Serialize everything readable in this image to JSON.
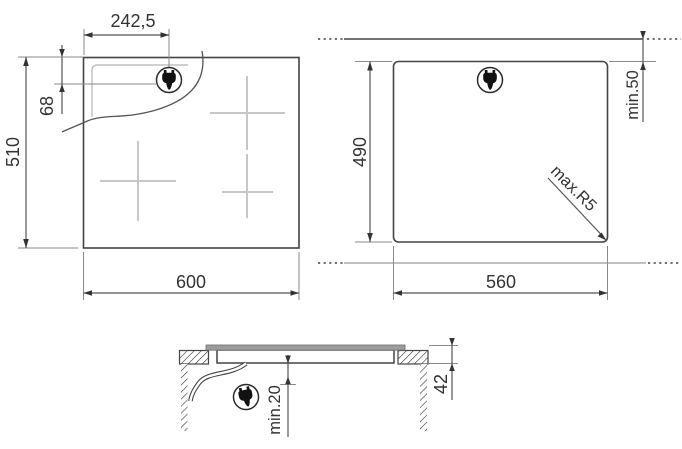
{
  "top_view": {
    "plug_offset_x": "242,5",
    "plug_offset_y": "68",
    "height": "510",
    "width": "600",
    "plug_icon": "power-plug-icon",
    "cooking_zones": 3
  },
  "cutout_view": {
    "height": "490",
    "width": "560",
    "wall_clearance": "min.50",
    "corner_radius": "max.R5",
    "plug_icon": "power-plug-icon"
  },
  "side_view": {
    "bottom_clearance": "min.20",
    "depth": "42",
    "plug_icon": "power-plug-icon"
  },
  "colors": {
    "object_line": "#444444",
    "dimension_line": "#555555",
    "extension_line": "#8a8a8a",
    "light_line": "#c7c7c7",
    "text": "#333333",
    "glass_fill": "#9c9c9c",
    "hatch": "#333333"
  }
}
